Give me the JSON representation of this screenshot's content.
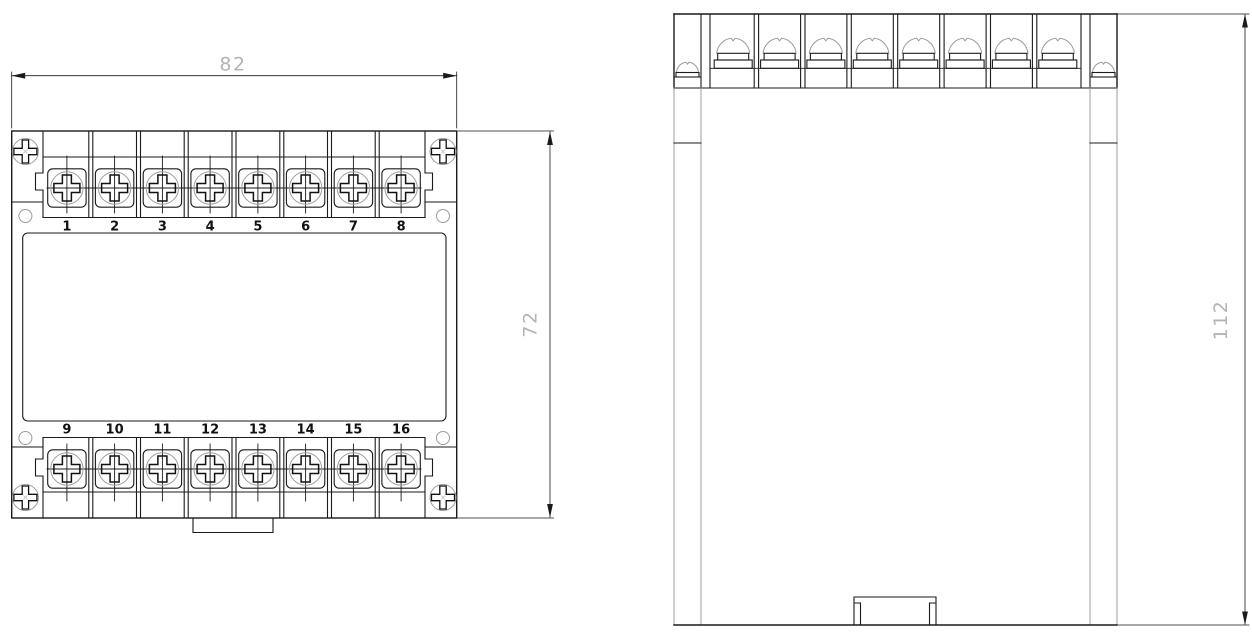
{
  "drawing": {
    "front_view": {
      "dim_width": "82",
      "dim_height": "72",
      "terminals_top": [
        "1",
        "2",
        "3",
        "4",
        "5",
        "6",
        "7",
        "8"
      ],
      "terminals_bottom": [
        "9",
        "10",
        "11",
        "12",
        "13",
        "14",
        "15",
        "16"
      ]
    },
    "side_view": {
      "dim_height": "112"
    },
    "colors": {
      "outline": "#1a1a1a",
      "thin_gray": "#9c9c9c",
      "dim_text": "#b4b4b4",
      "background": "#ffffff"
    }
  }
}
